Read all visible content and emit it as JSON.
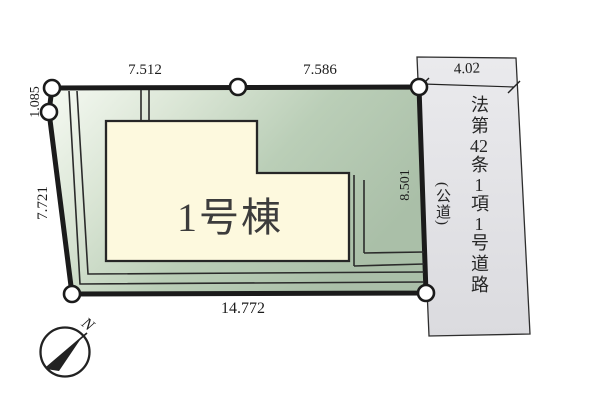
{
  "diagram": {
    "building": {
      "label": "1号棟"
    },
    "dimensions": {
      "top_left": "7.512",
      "top_right": "7.586",
      "road_width": "4.02",
      "left_upper": "1.085",
      "left_lower": "7.721",
      "right_side": "8.501",
      "bottom": "14.772"
    },
    "road": {
      "segments": [
        "法第",
        "42",
        "条",
        "1",
        "項",
        "1",
        "号道路"
      ],
      "sub_label": "(公道)"
    },
    "compass": {
      "north": "N"
    },
    "colors": {
      "outline": "#1b1b1b",
      "lot_light": "#f6faf3",
      "lot_green": "#aabfa8",
      "building_fill": "#fdf9de",
      "road_fill": "#e4e4e7"
    }
  }
}
